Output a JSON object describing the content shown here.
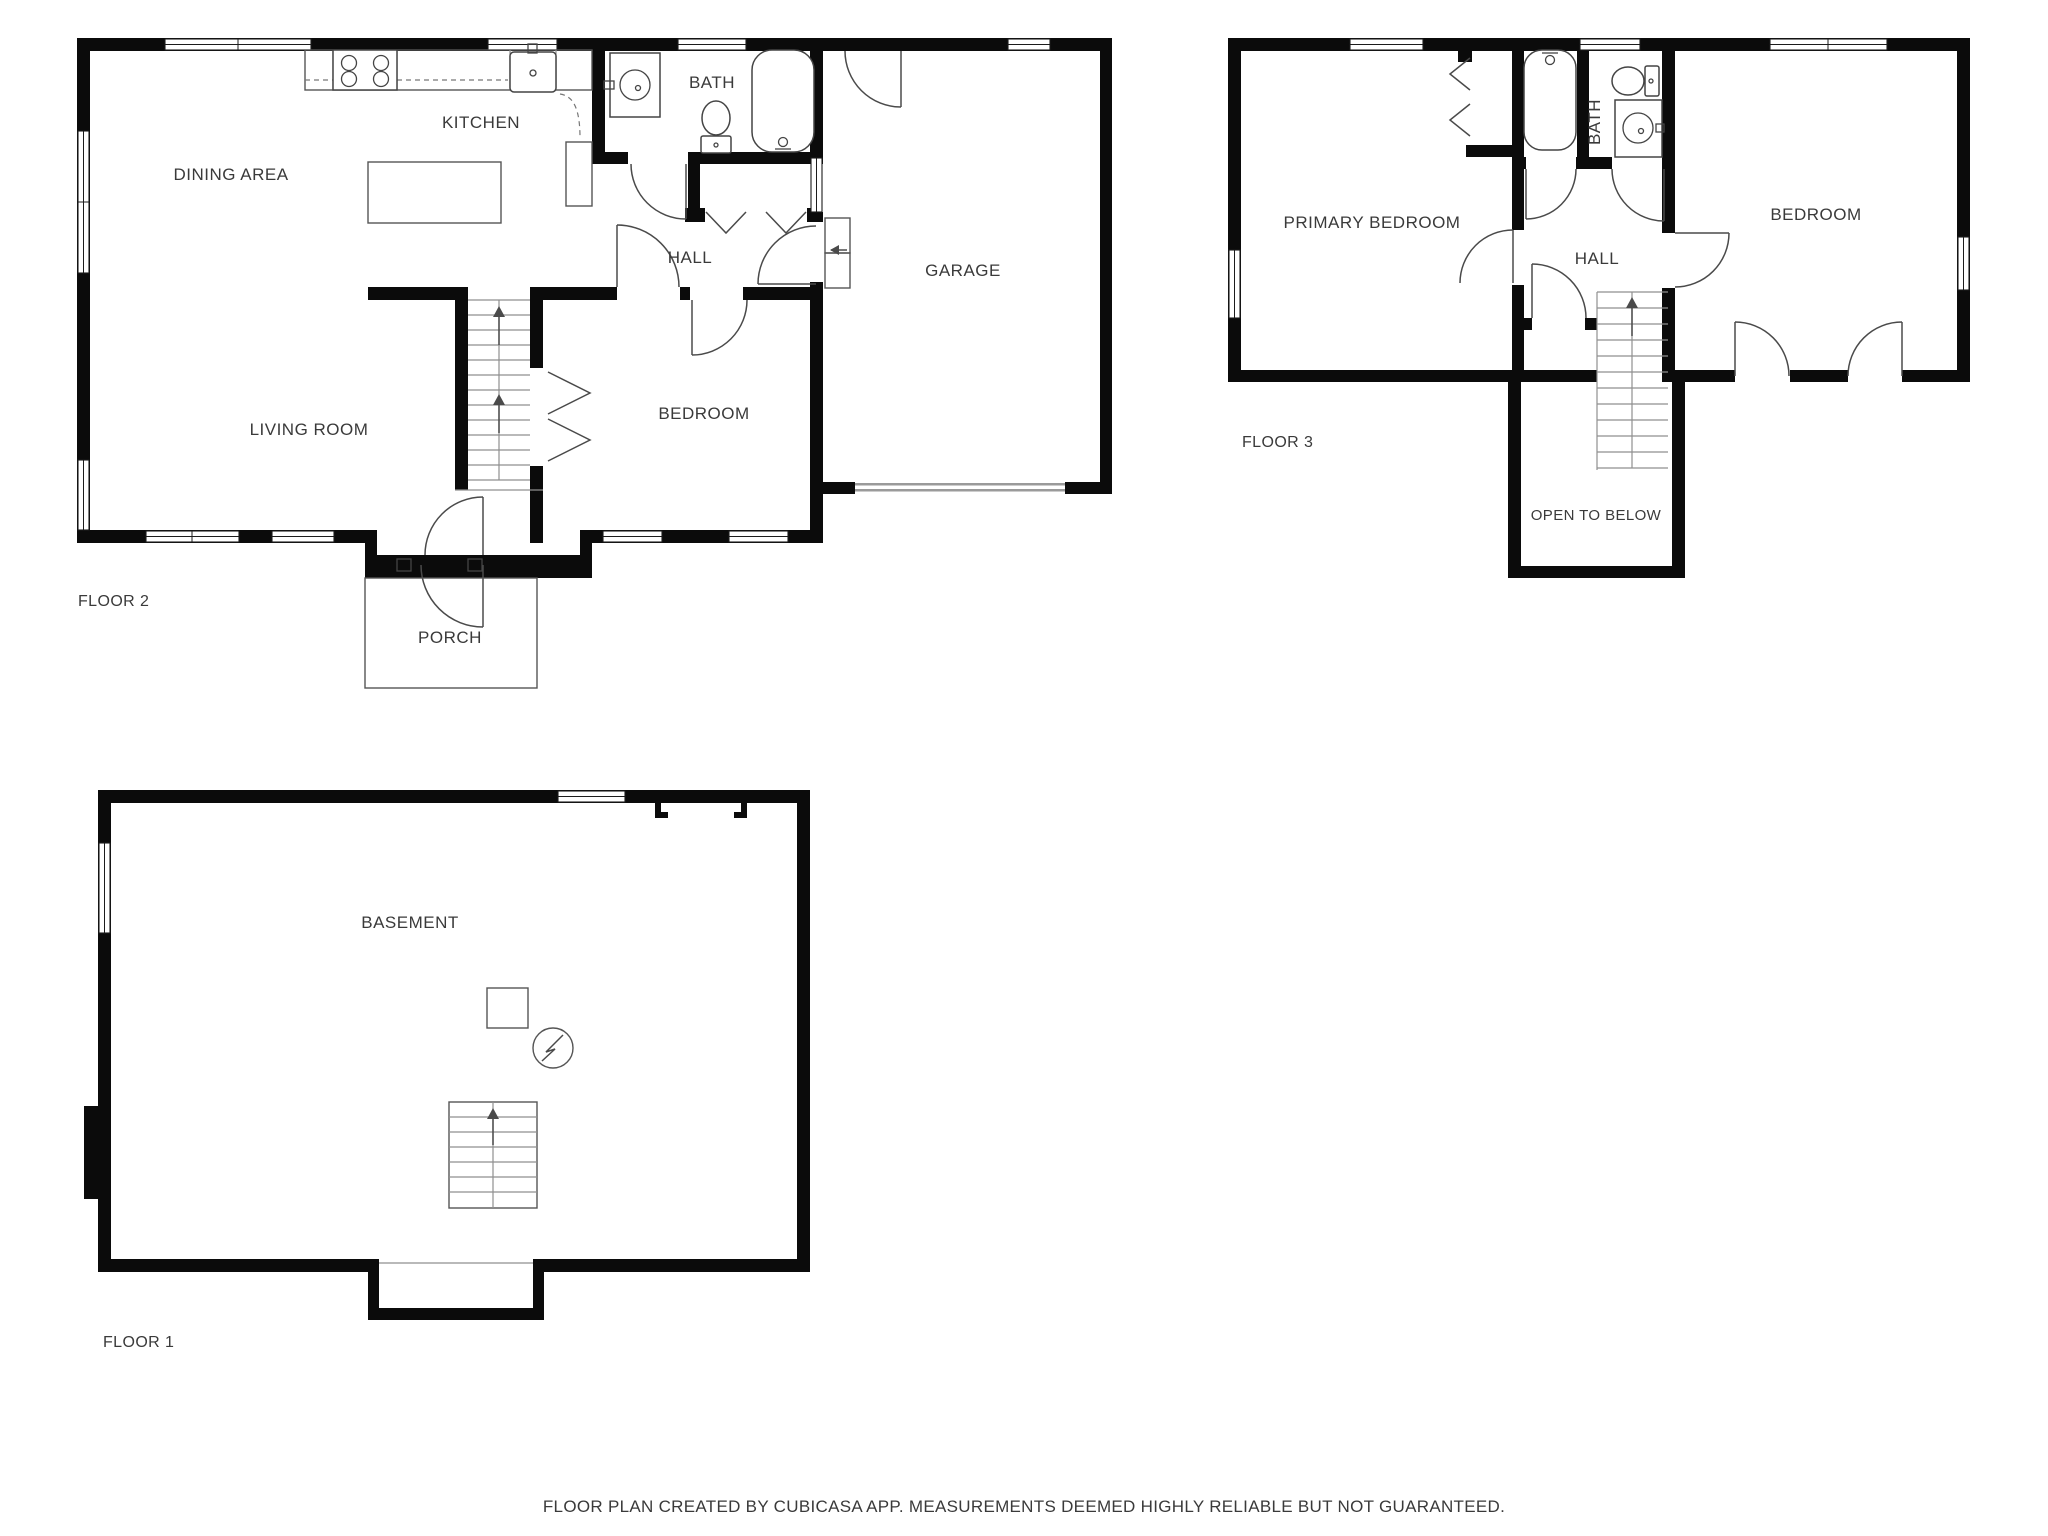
{
  "document": {
    "type": "floor-plan",
    "creator_note": "FLOOR PLAN CREATED BY CUBICASA APP. MEASUREMENTS DEEMED HIGHLY RELIABLE BUT NOT GUARANTEED."
  },
  "colors": {
    "wall": "#0b0b0b",
    "line": "#555555",
    "text": "#3a3a3a",
    "background": "#ffffff",
    "garage_door": "#9a9a9a"
  },
  "floor2": {
    "label": "FLOOR 2",
    "rooms": {
      "dining_area": "DINING AREA",
      "kitchen": "KITCHEN",
      "bath": "BATH",
      "hall": "HALL",
      "garage": "GARAGE",
      "living_room": "LIVING ROOM",
      "bedroom": "BEDROOM",
      "porch": "PORCH"
    }
  },
  "floor3": {
    "label": "FLOOR 3",
    "rooms": {
      "primary_bedroom": "PRIMARY BEDROOM",
      "bath": "BATH",
      "hall": "HALL",
      "bedroom": "BEDROOM",
      "open_to_below": "OPEN TO BELOW"
    }
  },
  "floor1": {
    "label": "FLOOR 1",
    "rooms": {
      "basement": "BASEMENT"
    }
  },
  "footer": {
    "text": "FLOOR PLAN CREATED BY CUBICASA APP. MEASUREMENTS DEEMED HIGHLY RELIABLE BUT NOT GUARANTEED."
  },
  "icons": {
    "stove": "4-burner-stove",
    "kitchen_sink": "kitchen-sink",
    "bath_sink": "round-basin-sink",
    "toilet": "toilet",
    "bathtub": "bathtub",
    "stairs_arrow": "up-arrow",
    "entry_arrow": "left-arrow",
    "electrical_panel": "circle-lightning-bolt",
    "furnace": "square-appliance"
  }
}
